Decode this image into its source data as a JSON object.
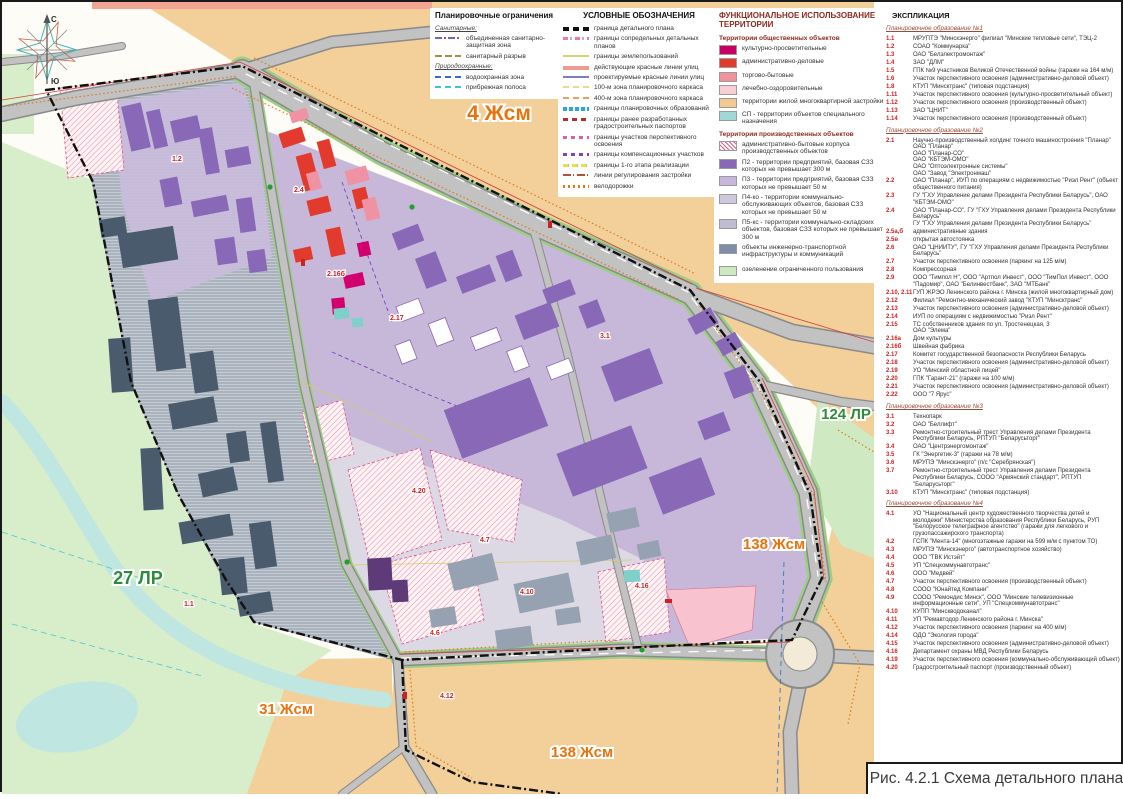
{
  "title_block": {
    "caption": "Рис. 4.2.1 Схема детального плана"
  },
  "compass": {
    "north": "С",
    "south": "Ю"
  },
  "colors": {
    "residential_zone": "#f3cf9a",
    "park_green": "#d8edca",
    "industrial_light_purple": "#c7b8da",
    "industrial_purple_building": "#8a68b8",
    "infrastructure_slate": "#7d8fa6",
    "admin_red": "#e23b2e",
    "cultural_magenta": "#c80064",
    "river_teal": "#bfe6e0",
    "road_gray": "#c2c2c2",
    "boundary_black": "#111111",
    "label_orange": "#e8730c",
    "label_green": "#2e8b3c"
  },
  "map_labels": {
    "zone_top": "4 Жсм",
    "zone_park_west": "27 ЛР",
    "zone_bottom_left": "31 Жсм",
    "zone_right_green": "124 ЛР",
    "zone_right_mid": "138 Жсм",
    "zone_bottom": "138 Жсм"
  },
  "plot_labels": [
    "1.1",
    "1.2",
    "2.4",
    "2.16б",
    "2.17",
    "3.1",
    "4.20",
    "4.7",
    "4.6",
    "4.10",
    "4.12",
    "4.16"
  ],
  "legend_restrictions": {
    "title": "Планировочные ограничения",
    "groups": [
      {
        "name": "Санитарные:",
        "items": [
          {
            "label": "объединенная санитарно-защитная зона",
            "swatch": "szz-united"
          },
          {
            "label": "санитарный разрыв",
            "swatch": "san-gap"
          }
        ]
      },
      {
        "name": "Природоохранные:",
        "items": [
          {
            "label": "водоохранная зона",
            "swatch": "water-zone"
          },
          {
            "label": "прибрежная полоса",
            "swatch": "coastal"
          }
        ]
      }
    ]
  },
  "legend_symbols": {
    "title": "УСЛОВНЫЕ ОБОЗНАЧЕНИЯ",
    "items": [
      {
        "label": "граница детального плана",
        "swatch": "detail-boundary"
      },
      {
        "label": "границы сопредельных детальных планов",
        "swatch": "adjacent-plans"
      },
      {
        "label": "границы землепользований",
        "swatch": "landuse"
      },
      {
        "label": "действующие красные линии улиц",
        "swatch": "red-existing"
      },
      {
        "label": "проектируемые красные линии улиц",
        "swatch": "red-planned"
      },
      {
        "label": "100-м зона планировочного каркаса",
        "swatch": "zone100"
      },
      {
        "label": "400-м зона планировочного каркаса",
        "swatch": "zone400"
      },
      {
        "label": "границы планировочных образований",
        "swatch": "formations"
      },
      {
        "label": "границы ранее разработанных градостроительных паспортов",
        "swatch": "passports"
      },
      {
        "label": "границы участков перспективного освоения",
        "swatch": "perspective"
      },
      {
        "label": "границы компенсационных участков",
        "swatch": "compensation"
      },
      {
        "label": "границы 1-го этапа реализации",
        "swatch": "stage1"
      },
      {
        "label": "линии регулирования застройки",
        "swatch": "regulation"
      },
      {
        "label": "велодорожки",
        "swatch": "bike"
      }
    ]
  },
  "legend_functional": {
    "title": "ФУНКЦИОНАЛЬНОЕ ИСПОЛЬЗОВАНИЕ ТЕРРИТОРИИ",
    "section_public": "Территории общественных объектов",
    "public_items": [
      {
        "label": "культурно-просветительные",
        "color": "#c80064"
      },
      {
        "label": "административно-деловые",
        "color": "#e23b2e"
      },
      {
        "label": "торгово-бытовые",
        "color": "#f0929e"
      },
      {
        "label": "лечебно-оздоровительные",
        "color": "#f7ced4"
      },
      {
        "label": "территории жилой многоквартирной застройки",
        "color": "#f3c98f"
      },
      {
        "label": "СП - территории объектов специального назначения",
        "color": "#9fd8d4"
      }
    ],
    "section_industrial": "Территории производственных объектов",
    "industrial_items": [
      {
        "label": "административно-бытовые корпуса производственных объектов",
        "color": "#ffffff",
        "hatch": true
      },
      {
        "label": "П2 - территории предприятий, базовая СЗЗ которых не превышает 300 м",
        "color": "#8a68b8"
      },
      {
        "label": "П3 - территории предприятий, базовая СЗЗ которых не превышает 50 м",
        "color": "#c9b6de"
      },
      {
        "label": "П4-ко - территории коммунально-обслуживающих объектов, базовая СЗЗ которых не превышает 50 м",
        "color": "#cfc9df"
      },
      {
        "label": "П5-кс - территории коммунально-складских объектов, базовая СЗЗ которых не превышает 300 м",
        "color": "#bfbcd4"
      },
      {
        "label": "объекты инженерно-транспортной инфраструктуры и коммуникаций",
        "color": "#7d8fa6"
      }
    ],
    "greenery_item": {
      "label": "озеленение ограниченного пользования",
      "color": "#cde9c2"
    }
  },
  "explication": {
    "title": "ЭКСПЛИКАЦИЯ",
    "sections": [
      {
        "heading": "Планировочное образование №1",
        "items": [
          {
            "num": "1.1",
            "text": "МРУПТЭ \"Минскэнерго\" филиал \"Минские тепловые сети\", ТЭЦ-2"
          },
          {
            "num": "1.2",
            "text": "СОАО \"Коммунарка\""
          },
          {
            "num": "1.3",
            "text": "ОАО \"Белэлектромонтаж\""
          },
          {
            "num": "1.4",
            "text": "ЗАО \"ДЛМ\""
          },
          {
            "num": "1.5",
            "text": "ГПК №9 участников Великой Отечественной войны (гаражи на 164 м/м)"
          },
          {
            "num": "1.6",
            "text": "Участок перспективного освоения (административно-деловой объект)"
          },
          {
            "num": "1.8",
            "text": "КТУП \"Минсктранс\" (типовая подстанция)"
          },
          {
            "num": "1.11",
            "text": "Участок перспективного освоения (культурно-просветительный объект)"
          },
          {
            "num": "1.12",
            "text": "Участок перспективного освоения (производственный объект)"
          },
          {
            "num": "1.13",
            "text": "ЗАО \"ЦНИТ\""
          },
          {
            "num": "1.14",
            "text": "Участок перспективного освоения (производственный объект)"
          }
        ]
      },
      {
        "heading": "Планировочное образование №2",
        "items": [
          {
            "num": "2.1",
            "text": "Научно-производственный холдинг точного машиностроения \"Планар\"\nОАО \"Планар\"\nОАО \"Планар-СО\"\nОАО \"КБТЭМ-ОМО\"\nОАО \"Оптоэлектронные системы\"\nОАО \"Завод \"Электронмаш\""
          },
          {
            "num": "2.2",
            "text": "ОАО \"Планар\", ИУП по операциям с недвижимостью \"Риэл Рент\" (объект общественного питания)"
          },
          {
            "num": "2.3",
            "text": "ГУ \"ГХУ Управление делами Президента Республики Беларусь\", ОАО \"КБТЭМ-ОМО\""
          },
          {
            "num": "2.4",
            "text": "ОАО \"Планар-СО\", ГУ \"ГХУ Управления делами Президента Республики Беларусь\"\nГУ \"ГХУ Управления делами Президента Республики Беларусь\""
          },
          {
            "num": "2.5а,б",
            "text": "административные здания"
          },
          {
            "num": "2.5в",
            "text": "открытая автостоянка"
          },
          {
            "num": "2.6",
            "text": "ОАО \"ЦНИИТУ\", ГУ \"ГХУ Управления делами Президента Республики Беларусь\""
          },
          {
            "num": "2.7",
            "text": "Участок перспективного освоения (паркинг на 125 м/м)"
          },
          {
            "num": "2.8",
            "text": "Компрессорная"
          },
          {
            "num": "2.9",
            "text": "ООО \"Тимпол Н\", ООО \"Артпол Инвест\", ООО \"ТимПол Инвест\", ООО \"Падомир\", ОАО \"Белинвестбанк\", ЗАО \"МТБанк\""
          },
          {
            "num": "2.10, 2.11",
            "text": "ГУП ЖРЭО Ленинского района г. Минска (жилой многоквартирный дом)"
          },
          {
            "num": "2.12",
            "text": "Филиал \"Ремонтно-механический завод \"КТУП \"Минсктранс\""
          },
          {
            "num": "2.13",
            "text": "Участок перспективного освоения (административно-деловой объект)"
          },
          {
            "num": "2.14",
            "text": "ИУП по операциям с недвижимостью \"Риэл Рент\""
          },
          {
            "num": "2.15",
            "text": "ТС собственников здания по ул. Тростенецкая, 3\nОАО \"Элема\""
          },
          {
            "num": "2.16а",
            "text": "Дом культуры"
          },
          {
            "num": "2.16б",
            "text": "Швейная фабрика"
          },
          {
            "num": "2.17",
            "text": "Комитет государственной безопасности Республики Беларусь"
          },
          {
            "num": "2.18",
            "text": "Участок перспективного освоения (административно-деловой объект)"
          },
          {
            "num": "2.19",
            "text": "УО \"Минский областной лицей\""
          },
          {
            "num": "2.20",
            "text": "ГПК \"Гарант-21\" (гаражи на 100 м/м)"
          },
          {
            "num": "2.21",
            "text": "Участок перспективного освоения (административно-деловой объект)"
          },
          {
            "num": "2.22",
            "text": "ООО \"7 Ярус\""
          }
        ]
      },
      {
        "heading": "Планировочное образование №3",
        "items": [
          {
            "num": "3.1",
            "text": "Технопарк"
          },
          {
            "num": "3.2",
            "text": "ОАО \"Беллифт\""
          },
          {
            "num": "3.3",
            "text": "Ремонтно-строительный трест Управления делами Президента Республики Беларусь, РПТУП \"Беларусьторг\""
          },
          {
            "num": "3.4",
            "text": "ОАО \"Центрэнергомонтаж\""
          },
          {
            "num": "3.5",
            "text": "ГК \"Энергетик-3\" (гаражи на 78 м/м)"
          },
          {
            "num": "3.6",
            "text": "МРУПЭ \"Минскэнерго\" (п/с \"Серебрянская\")"
          },
          {
            "num": "3.7",
            "text": "Ремонтно-строительный трест Управления делами Президента Республики Беларусь, СООО \"Армянский стандарт\", РПТУП \"Беларусьторг\""
          },
          {
            "num": "3.10",
            "text": "КТУП \"Минсктранс\" (типовая подстанция)"
          }
        ]
      },
      {
        "heading": "Планировочное образование №4",
        "items": [
          {
            "num": "4.1",
            "text": "УО \"Национальный центр художественного творчества детей и молодежи\" Министерства образования Республики Беларусь, РУП \"Белорусское телеграфное агентство\" (гаражи для легкового и грузопассажирского транспорта)"
          },
          {
            "num": "4.2",
            "text": "ГСПК \"Мента-14\" (многоэтажные гаражи на 599 м/м с пунктом ТО)"
          },
          {
            "num": "4.3",
            "text": "МРУПЭ \"Минскэнерго\" (автотранспортное хозяйство)"
          },
          {
            "num": "4.4",
            "text": "ООО \"ТВК Истэйт\""
          },
          {
            "num": "4.5",
            "text": "УП \"Спецкоммунавтотранс\""
          },
          {
            "num": "4.6",
            "text": "ООО \"Медвей\""
          },
          {
            "num": "4.7",
            "text": "Участок перспективного освоения (производственный объект)"
          },
          {
            "num": "4.8",
            "text": "СООО \"Юнайтед Компани\""
          },
          {
            "num": "4.9",
            "text": "СООО \"Ремондис Минск\", ООО \"Минские телевизионные информационные сети\", УП \"Спецкоммунавтотранс\""
          },
          {
            "num": "4.10",
            "text": "КУПП \"Минскводоканал\""
          },
          {
            "num": "4.11",
            "text": "УП \"Ремавтодор Ленинского района г. Минска\""
          },
          {
            "num": "4.12",
            "text": "Участок перспективного освоения (паркинг на 400 м/м)"
          },
          {
            "num": "4.14",
            "text": "ОДО \"Экология города\""
          },
          {
            "num": "4.15",
            "text": "Участок перспективного освоения (административно-деловой объект)"
          },
          {
            "num": "4.16",
            "text": "Департамент охраны МВД Республики Беларусь"
          },
          {
            "num": "4.19",
            "text": "Участок перспективного освоения (коммунально-обслуживающий объект)"
          },
          {
            "num": "4.20",
            "text": "Градостроительный паспорт (производственный объект)"
          }
        ]
      }
    ]
  }
}
